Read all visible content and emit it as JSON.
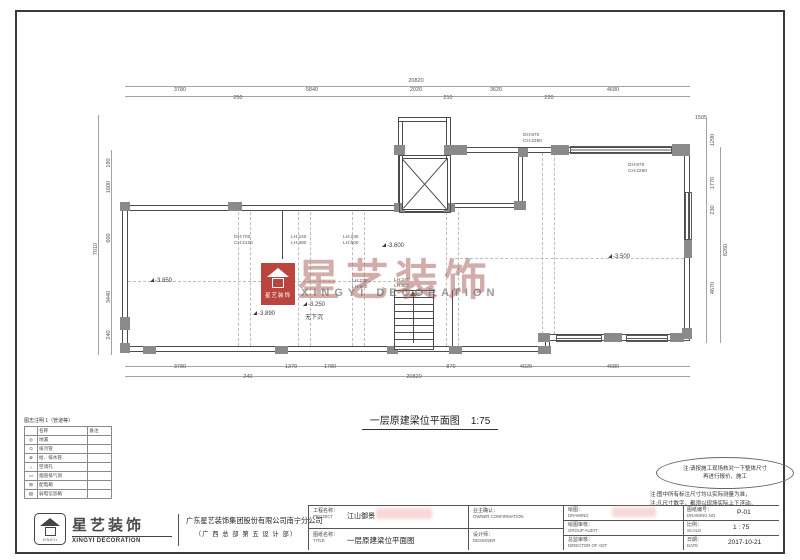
{
  "sheet": {
    "plan_title": "一层原建梁位平面图",
    "plan_scale": "1:75"
  },
  "watermark": {
    "cn": "星艺装饰",
    "en": "XINGYI DECORATION",
    "box_text": "星艺装饰"
  },
  "plan": {
    "dim_labels": [
      {
        "t": "20820",
        "x": 416,
        "y": 81
      },
      {
        "t": "3780",
        "x": 180,
        "y": 90
      },
      {
        "t": "5840",
        "x": 312,
        "y": 90
      },
      {
        "t": "2020",
        "x": 416,
        "y": 90
      },
      {
        "t": "3620",
        "x": 496,
        "y": 90
      },
      {
        "t": "4680",
        "x": 613,
        "y": 90
      },
      {
        "t": "250",
        "x": 238,
        "y": 98
      },
      {
        "t": "210",
        "x": 448,
        "y": 98
      },
      {
        "t": "220",
        "x": 549,
        "y": 98
      },
      {
        "t": "190",
        "x": 109,
        "y": 163,
        "r": 1
      },
      {
        "t": "1600",
        "x": 109,
        "y": 187,
        "r": 1
      },
      {
        "t": "7010",
        "x": 96,
        "y": 249,
        "r": 1
      },
      {
        "t": "600",
        "x": 109,
        "y": 238,
        "r": 1
      },
      {
        "t": "3440",
        "x": 109,
        "y": 297,
        "r": 1
      },
      {
        "t": "240",
        "x": 109,
        "y": 335,
        "r": 1
      },
      {
        "t": "1505",
        "x": 701,
        "y": 118
      },
      {
        "t": "1290",
        "x": 713,
        "y": 140,
        "r": 1
      },
      {
        "t": "1770",
        "x": 713,
        "y": 183,
        "r": 1
      },
      {
        "t": "230",
        "x": 713,
        "y": 210,
        "r": 1
      },
      {
        "t": "8260",
        "x": 726,
        "y": 250,
        "r": 1
      },
      {
        "t": "4670",
        "x": 713,
        "y": 288,
        "r": 1
      },
      {
        "t": "3780",
        "x": 180,
        "y": 367
      },
      {
        "t": "1370",
        "x": 291,
        "y": 367
      },
      {
        "t": "1780",
        "x": 330,
        "y": 367
      },
      {
        "t": "870",
        "x": 451,
        "y": 367
      },
      {
        "t": "4020",
        "x": 526,
        "y": 367
      },
      {
        "t": "4680",
        "x": 613,
        "y": 367
      },
      {
        "t": "240",
        "x": 248,
        "y": 377
      },
      {
        "t": "20820",
        "x": 414,
        "y": 377
      }
    ],
    "level_labels": [
      {
        "t": "-3.850",
        "x": 150,
        "y": 278
      },
      {
        "t": "-3.890",
        "x": 253,
        "y": 311
      },
      {
        "t": "-3.250",
        "x": 303,
        "y": 302
      },
      {
        "t": "-3.600",
        "x": 382,
        "y": 243
      },
      {
        "t": "-3.500",
        "x": 608,
        "y": 254
      }
    ],
    "plain_labels": [
      {
        "t": "无下沉",
        "x": 305,
        "y": 312
      }
    ],
    "height_labels": [
      {
        "l1": "DH:700",
        "l2": "CH:2100",
        "x": 234,
        "y": 235
      },
      {
        "l1": "LH:240",
        "l2": "LH:380",
        "x": 291,
        "y": 235
      },
      {
        "l1": "LH:230",
        "l2": "LH:500",
        "x": 343,
        "y": 235
      },
      {
        "l1": "LH:230",
        "l2": "LH:500",
        "x": 352,
        "y": 279
      },
      {
        "l1": "LH:240",
        "l2": "LH:500",
        "x": 394,
        "y": 278
      },
      {
        "l1": "DH:970",
        "l2": "CH:2260",
        "x": 523,
        "y": 133
      },
      {
        "l1": "DH:970",
        "l2": "CH:2260",
        "x": 628,
        "y": 163
      }
    ]
  },
  "legend": {
    "title": "图志注明 1（管道等）",
    "headers": [
      "",
      "名称",
      "备注"
    ],
    "rows": [
      [
        "◎",
        "地漏",
        ""
      ],
      [
        "⊙",
        "排污管",
        ""
      ],
      [
        "⊕",
        "给、排水管",
        ""
      ],
      [
        "○",
        "空调孔",
        ""
      ],
      [
        "▭",
        "烟道排气洞",
        ""
      ],
      [
        "⊞",
        "配电箱",
        ""
      ],
      [
        "▤",
        "弱电信息箱",
        ""
      ]
    ]
  },
  "notes": {
    "cloud_line1": "注:请按施工现场核对一下整体尺寸",
    "cloud_line2": "再进行报价、施工",
    "line1": "注:图中所有标注尺寸均以实际测量为准，",
    "line2": "注:凡尺寸数字，都须以现场实际上下浮动。"
  },
  "titleblock": {
    "logo_en_small": "XINGYI",
    "logotype_cn": "星艺装饰",
    "logotype_en": "XINGYI DECORATION",
    "company_line1": "广东星艺装饰集团股份有限公司南宁分公司",
    "company_line2": "（广 西 总 部 第 五 设 计 部）",
    "project_label": "工程名称：",
    "project_en": "PROJECT",
    "project_value": "江山御景",
    "owner_label": "业主确认：",
    "owner_en": "OWNER CONFIRMATION",
    "title_label": "图纸名称：",
    "title_en": "TITLE",
    "title_value": "一层原建梁位平面图",
    "designer_label": "设计师：",
    "designer_en": "DESIGNER",
    "drawing_label": "绘图：",
    "drawing_en": "DRAWING",
    "audit_label": "绘图审核：",
    "audit_en": "GROUP AUDIT",
    "director_label": "总监审核：",
    "director_en": "DIRECTOR OF ADT",
    "no_label": "图纸编号：",
    "no_en": "DRAWING NO",
    "no_value": "P-01",
    "scale_label": "比例：",
    "scale_en": "SCALE",
    "scale_value": "1 : 75",
    "date_label": "日期：",
    "date_en": "DATE",
    "date_value": "2017-10-21"
  },
  "colors": {
    "accent_red": "#b5342e",
    "line": "#4b4b4b",
    "pillar": "#8a8a8a"
  }
}
